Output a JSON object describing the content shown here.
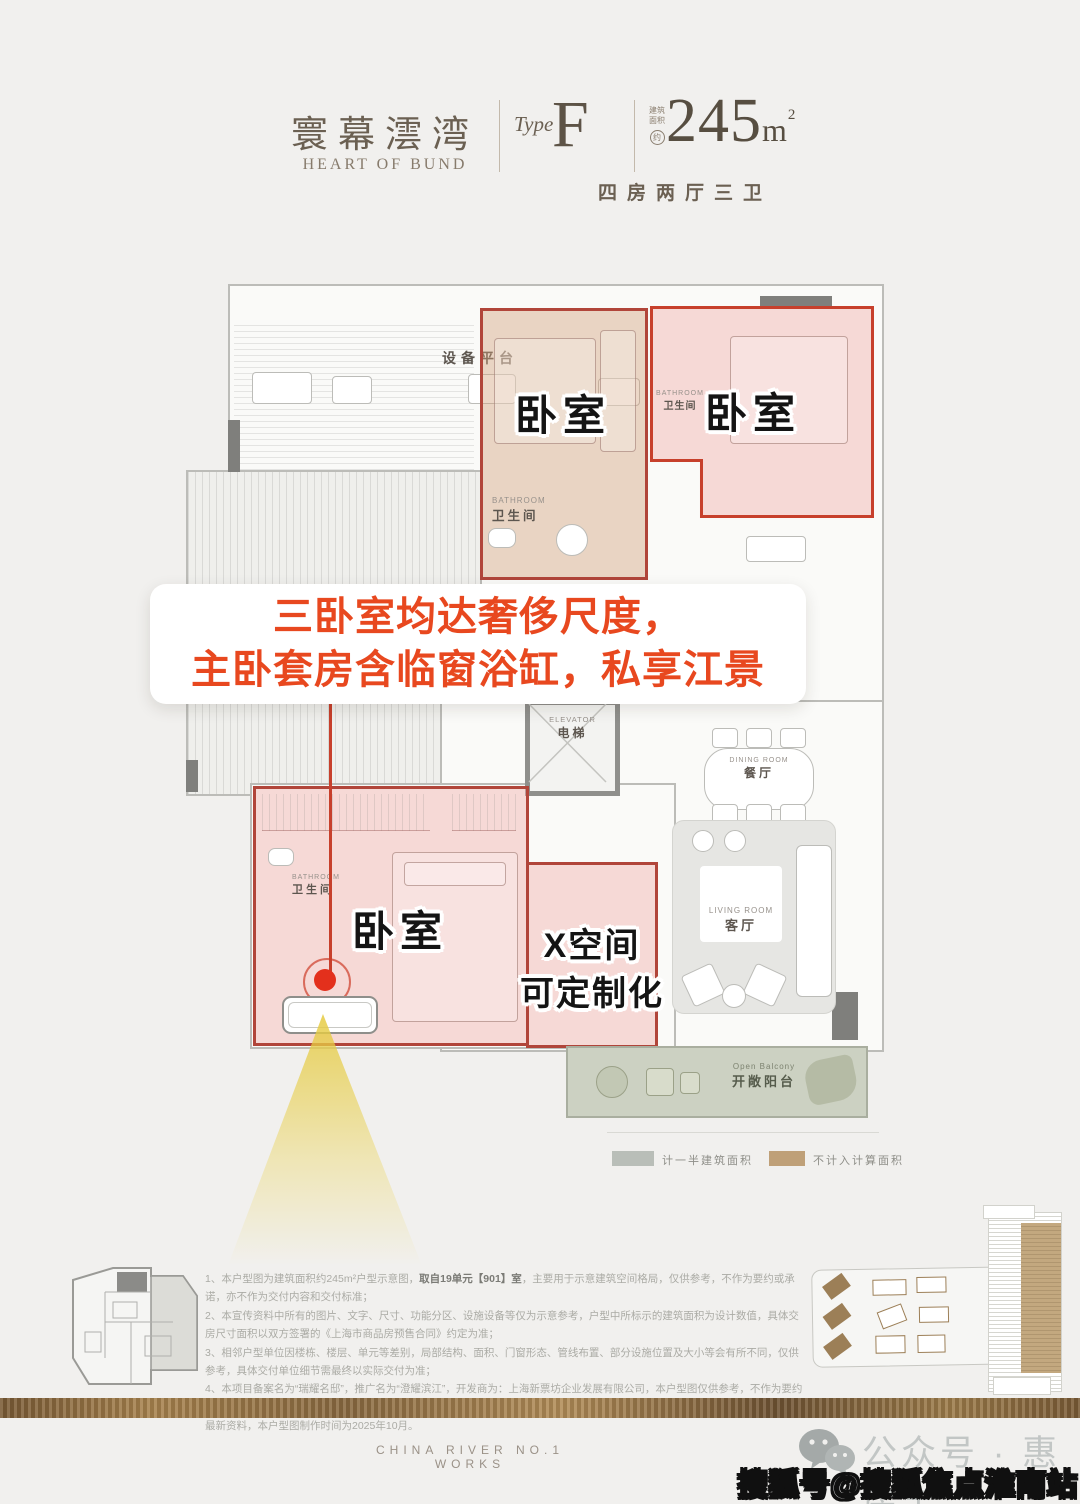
{
  "header": {
    "brand_cn": "寰幕澐湾",
    "brand_en": "HEART OF BUND",
    "type_label": "Type",
    "type_value": "F",
    "area_note_line1": "建筑",
    "area_note_line2": "面积",
    "area_note_circle": "约",
    "area_value": "245",
    "area_unit": "m",
    "area_sup": "2",
    "layout_desc": "四房两厅三卫"
  },
  "callout": {
    "line1": "三卧室均达奢侈尺度，",
    "line2": "主卧套房含临窗浴缸，私享江景"
  },
  "plan": {
    "equipment_platform": "设备平台",
    "bedroom": "卧室",
    "bathroom_en": "BATHROOM",
    "bathroom_cn": "卫生间",
    "elevator_en": "ELEVATOR",
    "elevator_cn": "电梯",
    "dining_en": "DINING ROOM",
    "dining_cn": "餐厅",
    "living_en": "LIVING ROOM",
    "living_cn": "客厅",
    "balcony_en": "Open Balcony",
    "balcony_cn": "开敞阳台",
    "xspace_line1": "X空间",
    "xspace_line2": "可定制化"
  },
  "legend": {
    "half_area_label": "计一半建筑面积",
    "half_area_color": "#b9beb8",
    "excluded_label": "不计入计算面积",
    "excluded_color": "#bfa078"
  },
  "disclaimer": {
    "l1a": "1、本户型图为建筑面积约245m²户型示意图，",
    "l1b": "取自19单元【901】室",
    "l1c": "，主要用于示意建筑空间格局，仅供参考，不作为要约或承诺，亦不作为交付内容和交付标准；",
    "l2": "2、本宣传资料中所有的图片、文字、尺寸、功能分区、设施设备等仅为示意参考，户型中所标示的建筑面积为设计数值，具体交房尺寸面积以双方签署的《上海市商品房预售合同》约定为准；",
    "l3": "3、相邻户型单位因楼栋、楼层、单元等差别，局部结构、面积、门窗形态、管线布置、部分设施位置及大小等会有所不同，仅供参考，具体交付单位细节需最终以实际交付为准；",
    "l4": "4、本项目备案名为“瑞耀名邸”，推广名为“澄耀滨江”，开发商为：上海新票坊企业发展有限公司，本户型图仅供参考，不作为要约邀请，相关内容不排除因政府相关规划、规定及开发商未能预见的原因而发生变化，本公司保留对宣传资料修改的权利，敬请留意最新资料，本户型图制作时间为2025年10月。"
  },
  "footer": {
    "works_en": "CHINA RIVER NO.1 WORKS",
    "wechat_label": "公众号 · 惠房宝",
    "watermark": "搜狐号@搜狐焦点淮南站"
  },
  "accent_colors": {
    "callout_orange": "#e8481f",
    "overlay_border_red": "#b1453a",
    "dot_red": "#e3301c",
    "cone_yellow": "#e5ca3f",
    "gold_band": "#a8834e"
  }
}
